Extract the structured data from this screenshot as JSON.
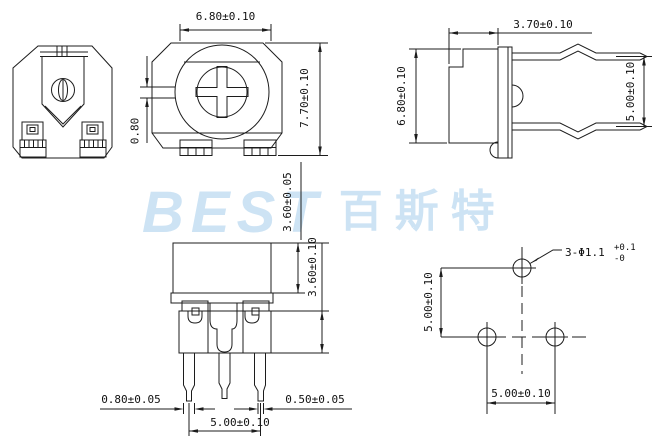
{
  "drawing": {
    "watermark": {
      "latin": "BEST",
      "cjk": "百斯特"
    },
    "front_view": {
      "width": "6.80±0.10",
      "height": "7.70±0.10",
      "slot_width": "0.80"
    },
    "side_view": {
      "depth": "3.70±0.10",
      "height": "6.80±0.10",
      "pin_pitch": "5.00±0.10"
    },
    "bottom_view": {
      "standoff": "3.60±0.05",
      "body_height": "3.60±0.10",
      "lead_width": "0.80±0.05",
      "lead_tip_width": "0.50±0.05",
      "lead_pitch": "5.00±0.10"
    },
    "hole_view": {
      "vertical_pitch": "5.00±0.10",
      "horizontal_pitch": "5.00±0.10",
      "hole_callout": "3-Φ1.1",
      "tol_upper": "+0.1",
      "tol_lower": "-0"
    }
  }
}
